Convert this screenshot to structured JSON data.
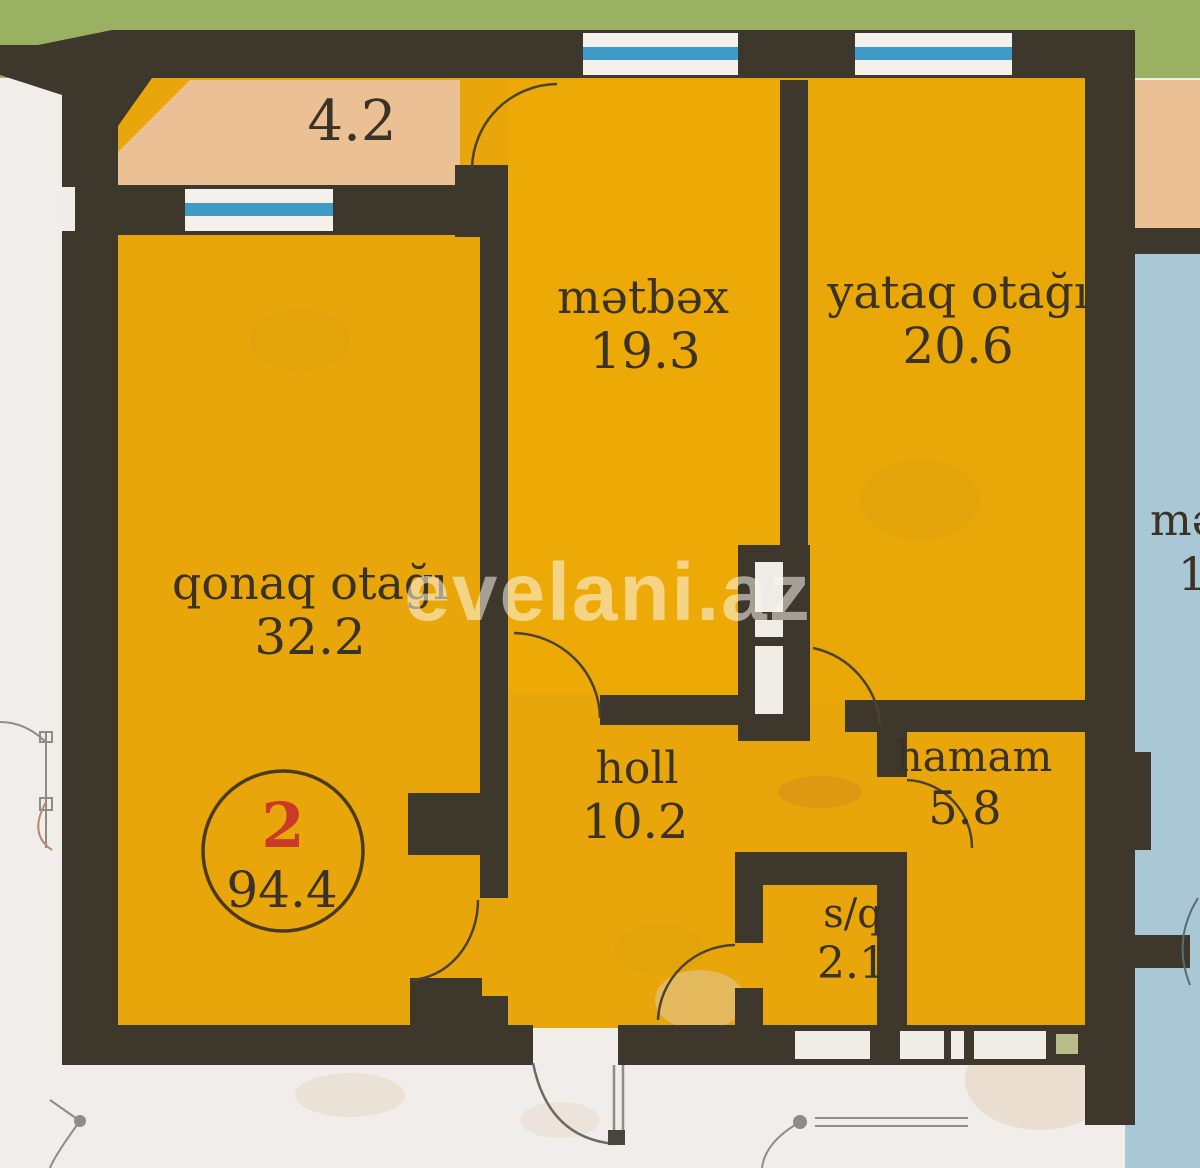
{
  "floorplan": {
    "watermark": "evelani.az",
    "unit_badge": {
      "unit_number": "2",
      "total_area": "94.4"
    },
    "balcony": {
      "area": "4.2"
    },
    "rooms": [
      {
        "name": "living-room",
        "label": "qonaq otağı",
        "area": "32.2"
      },
      {
        "name": "kitchen",
        "label": "mətbəx",
        "area": "19.3"
      },
      {
        "name": "bedroom",
        "label": "yataq otağı",
        "area": "20.6"
      },
      {
        "name": "hall",
        "label": "holl",
        "area": "10.2"
      },
      {
        "name": "bathroom",
        "label": "hamam",
        "area": "5.8"
      },
      {
        "name": "wc",
        "label": "s/q",
        "area": "2.1"
      }
    ],
    "adjacent_unit": {
      "partial_label": "mə",
      "partial_area": "19"
    },
    "colors": {
      "wall": "#3d372c",
      "room_fill": "#e8a60a",
      "balcony_fill": "#ecc095",
      "outside": "#f0edea",
      "grass_band": "#9ab164",
      "neighbor_room": "#a9c7d5",
      "window_glass": "#3e9ac6",
      "badge_number": "#c93a28",
      "label_text": "#3a3226"
    }
  }
}
